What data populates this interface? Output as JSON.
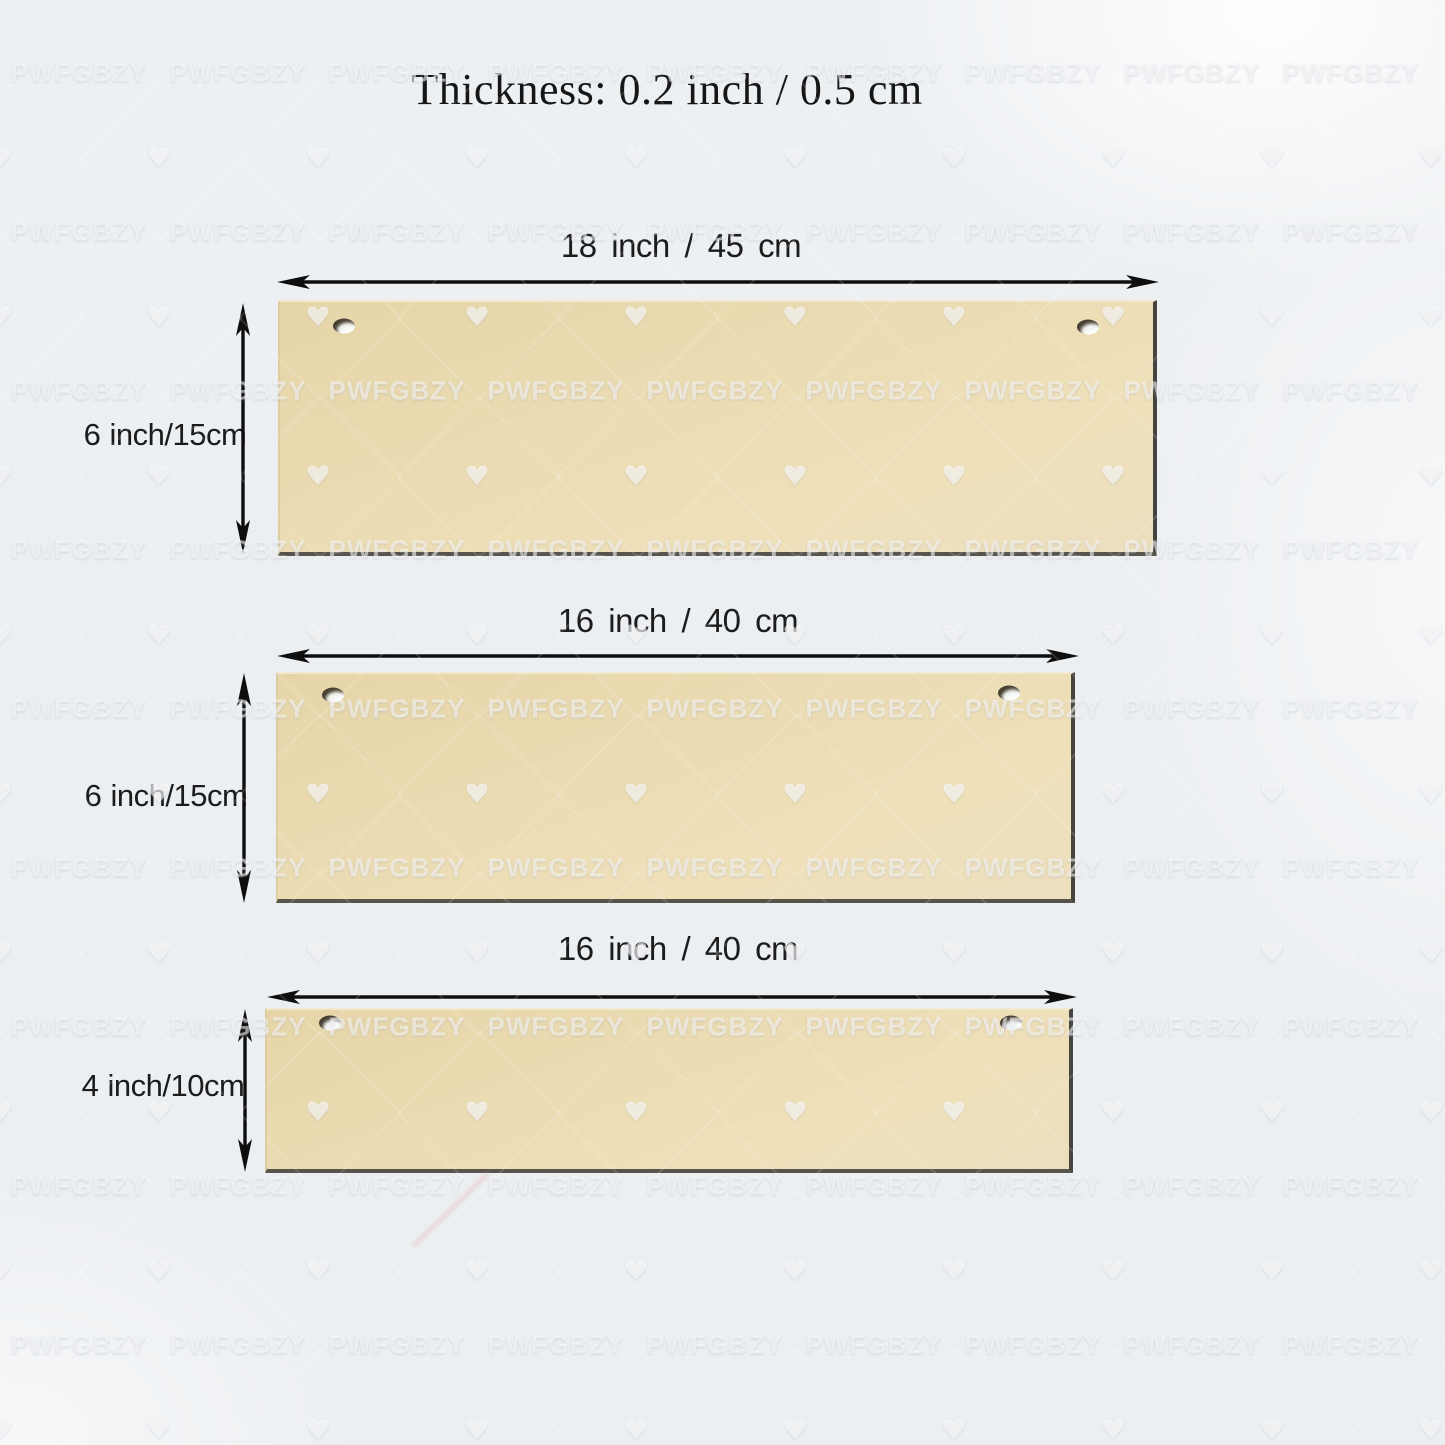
{
  "title": "Thickness: 0.2 inch / 0.5 cm",
  "watermark": {
    "text": "PWFGBZY"
  },
  "colors": {
    "background": "#edf0f3",
    "board_wood": "#ebdbb2",
    "board_edge_dark": "#4a483f",
    "arrow": "#0e0e0e",
    "label_text": "#1c1c1c"
  },
  "boards": [
    {
      "width_label": "18 inch / 45 cm",
      "height_label": "6 inch/15cm"
    },
    {
      "width_label": "16 inch / 40 cm",
      "height_label": "6 inch/15cm"
    },
    {
      "width_label": "16 inch / 40 cm",
      "height_label": "4 inch/10cm"
    }
  ]
}
